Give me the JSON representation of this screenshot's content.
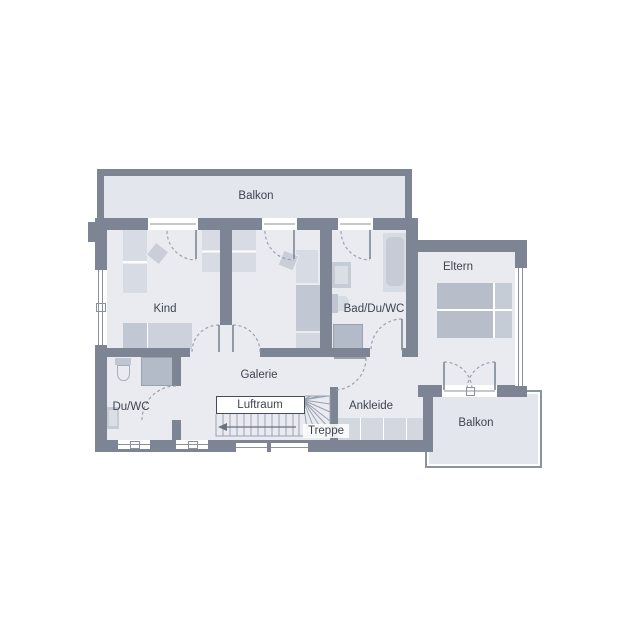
{
  "rooms": {
    "balkon_top": "Balkon",
    "kind": "Kind",
    "bad_du_wc": "Bad/Du/WC",
    "eltern": "Eltern",
    "du_wc": "Du/WC",
    "galerie": "Galerie",
    "luftraum": "Luftraum",
    "ankleide": "Ankleide",
    "treppe": "Treppe",
    "balkon_bottom": "Balkon"
  },
  "colors": {
    "wall": "#7d8493",
    "room_fill": "#e9ebf0",
    "balcony_fill": "#e3e6ec",
    "furn_light": "#d7dbe3",
    "furn_med": "#c3c9d3",
    "furn_dark": "#b4bbc8",
    "line": "#8a92a2",
    "text": "#3e4450"
  }
}
